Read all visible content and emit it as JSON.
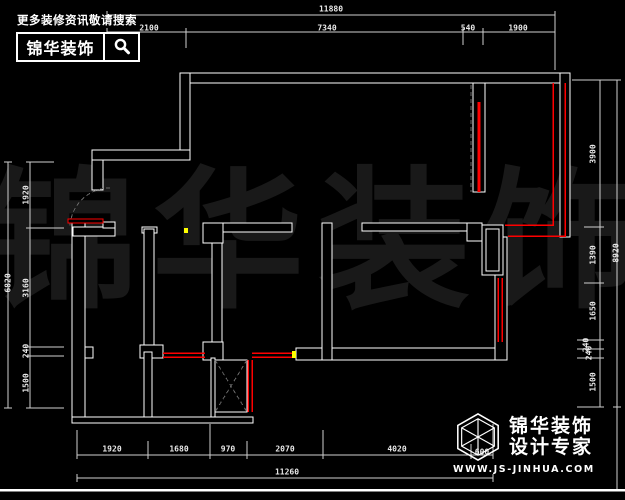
{
  "topbar": {
    "hint": "更多装修资讯敬请搜索",
    "brand": "锦华装饰",
    "search_icon": "magnifier"
  },
  "watermark": "锦华装饰",
  "dims": {
    "top": {
      "overall": "11880",
      "segments": [
        "2100",
        "7340",
        "540",
        "1900"
      ]
    },
    "bottom": {
      "overall": "11260",
      "segments": [
        "1920",
        "1680",
        "970",
        "2070",
        "4020",
        "600"
      ]
    },
    "left": {
      "overall": "6820",
      "segments": [
        "1920",
        "3160",
        "240",
        "1500"
      ]
    },
    "right": {
      "overall": "8920",
      "segments": [
        "3900",
        "1390",
        "1650",
        "240",
        "240",
        "1500"
      ]
    }
  },
  "footer": {
    "logo_icon": "hexagon-cube",
    "brand_top": "锦华装饰",
    "brand_bottom": "设计专家",
    "website": "WWW.JS-JINHUA.COM"
  },
  "colors": {
    "background": "#000000",
    "walls": "#ffffff",
    "highlight_red": "#ff0000",
    "accent_yellow": "#ffff00",
    "dimension": "#e8e8e8",
    "watermark": "#191919"
  }
}
